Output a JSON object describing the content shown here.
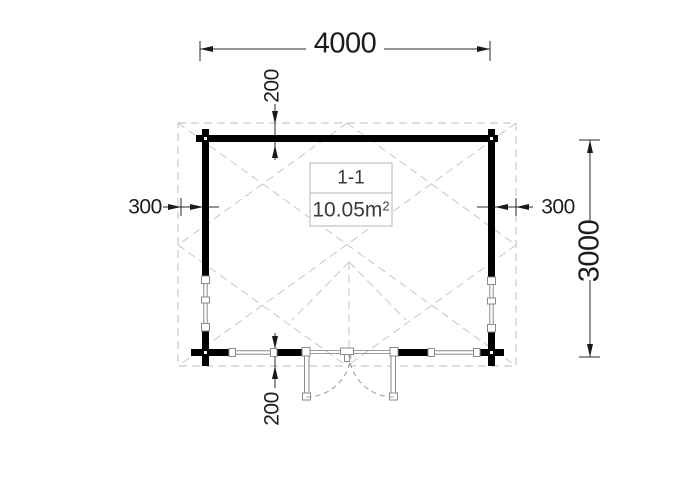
{
  "drawing": {
    "title": "floor-plan-4000x3000-cabin",
    "room": {
      "label": "1-1",
      "area": "10.05m",
      "area_sup": "2"
    },
    "dims": {
      "width_top": "4000",
      "overhang_top": "200",
      "overhang_left": "300",
      "overhang_right": "300",
      "depth_right": "3000",
      "overhang_bottom": "200"
    },
    "colors": {
      "background": "#ffffff",
      "wall": "#000000",
      "dimension": "#1a1a1a",
      "roof_dash": "#cbcbcb",
      "window_frame": "#8a8a8a",
      "door_swing": "#9a9a9a",
      "label_border": "#b5b5b5",
      "label_text": "#3b3b3b"
    }
  }
}
